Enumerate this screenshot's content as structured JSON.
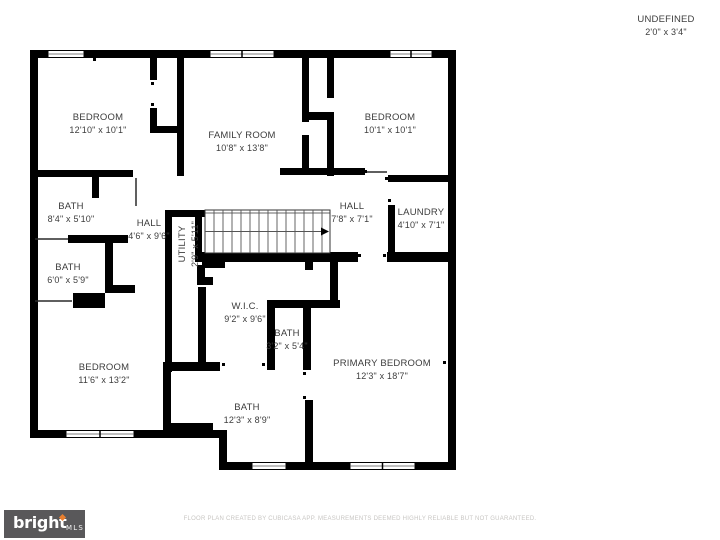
{
  "undefined_space": {
    "name": "UNDEFINED",
    "dims": "2'0\" x 3'4\""
  },
  "rooms": [
    {
      "name": "BEDROOM",
      "dims": "12'10\" x 10'1\""
    },
    {
      "name": "FAMILY ROOM",
      "dims": "10'8\" x 13'8\""
    },
    {
      "name": "BEDROOM",
      "dims": "10'1\" x 10'1\""
    },
    {
      "name": "BATH",
      "dims": "8'4\" x 5'10\""
    },
    {
      "name": "HALL",
      "dims": "4'6\" x 9'6\""
    },
    {
      "name": "UTILITY",
      "dims": "2'9\" x 5'11\""
    },
    {
      "name": "HALL",
      "dims": "7'8\" x 7'1\""
    },
    {
      "name": "LAUNDRY",
      "dims": "4'10\" x 7'1\""
    },
    {
      "name": "BATH",
      "dims": "6'0\" x 5'9\""
    },
    {
      "name": "W.I.C.",
      "dims": "9'2\" x 9'6\""
    },
    {
      "name": "BATH",
      "dims": "3'2\" x 5'4\""
    },
    {
      "name": "BEDROOM",
      "dims": "11'6\" x 13'2\""
    },
    {
      "name": "PRIMARY BEDROOM",
      "dims": "12'3\" x 18'7\""
    },
    {
      "name": "BATH",
      "dims": "12'3\" x 8'9\""
    }
  ],
  "colors": {
    "wall": "#000000",
    "label": "#3d3d3d",
    "logo_background": "#59585a",
    "logo_accent": "#e87f2f",
    "disclaimer": "#c8c6c3"
  },
  "footer": {
    "logo": {
      "brand": "bright",
      "suffix": "MLS"
    },
    "disclaimer": "FLOOR PLAN CREATED BY CUBICASA APP. MEASUREMENTS DEEMED HIGHLY RELIABLE BUT NOT GUARANTEED."
  }
}
